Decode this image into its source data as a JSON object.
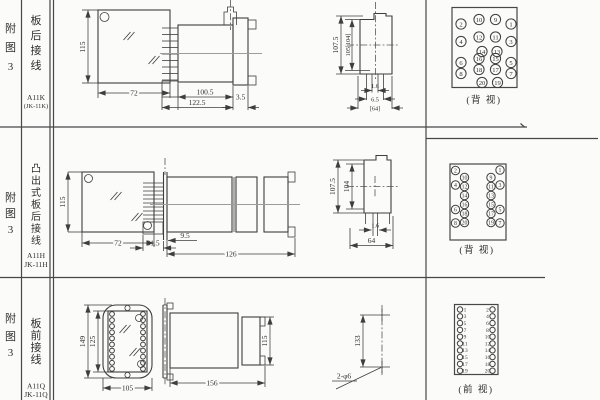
{
  "sheet": {
    "background": "#fbfbf9",
    "line_color": "#3e3e3e"
  },
  "rows": [
    {
      "fig": [
        "附",
        "图",
        "3"
      ],
      "wiring": [
        "板",
        "后",
        "接",
        "线"
      ],
      "model1": "A11K",
      "model2": "(JK-11K)",
      "view_label": "(背 视)",
      "front": {
        "h": "115",
        "w": "72"
      },
      "side": {
        "body": "100.5",
        "total": "122.5",
        "flange": "3.5"
      },
      "rear": {
        "h_outer": "107.5",
        "h_inner": "105[104]",
        "d1": "1.6",
        "d2": "6.5",
        "d3": "[64]"
      }
    },
    {
      "fig": [
        "附",
        "图",
        "3"
      ],
      "wiring": [
        "凸",
        "出",
        "式",
        "板",
        "后",
        "接",
        "线"
      ],
      "model1": "A11H",
      "model2": "JK-11H",
      "view_label": "(背 视)",
      "front": {
        "h": "115",
        "w": "72"
      },
      "side": {
        "offset": "9.5",
        "pins": "31.5",
        "total": "126"
      },
      "rear": {
        "h_outer": "107.5",
        "h_inner": "104",
        "d1": "1.6",
        "d2": "64"
      }
    },
    {
      "fig": [
        "附",
        "图",
        "3"
      ],
      "wiring": [
        "板",
        "前",
        "接",
        "线"
      ],
      "model1": "A11Q",
      "model2": "JK-11Q",
      "view_label": "(前 视)",
      "front": {
        "h_outer": "149",
        "h_inner": "125",
        "w": "105"
      },
      "side": {
        "total": "156",
        "sock_h": "115"
      },
      "holes": {
        "span": "133",
        "label": "2-φ6"
      }
    }
  ],
  "pin_diagrams": [
    {
      "name": "rear-view-grid-20pin",
      "r": 5.1,
      "font": 6.6,
      "pins": [
        {
          "n": "2",
          "x": 461,
          "y": 24
        },
        {
          "n": "10",
          "x": 479,
          "y": 19.5
        },
        {
          "n": "9",
          "x": 495.5,
          "y": 19.5
        },
        {
          "n": "1",
          "x": 511,
          "y": 24
        },
        {
          "n": "4",
          "x": 461,
          "y": 41.5
        },
        {
          "n": "12",
          "x": 479,
          "y": 37
        },
        {
          "n": "11",
          "x": 495.5,
          "y": 37
        },
        {
          "n": "3",
          "x": 511,
          "y": 41.5
        },
        {
          "n": "14",
          "x": 482,
          "y": 51.5
        },
        {
          "n": "13",
          "x": 497,
          "y": 51.5
        },
        {
          "n": "6",
          "x": 461,
          "y": 62.5
        },
        {
          "n": "16",
          "x": 479,
          "y": 58.5
        },
        {
          "n": "15",
          "x": 495.5,
          "y": 58.5
        },
        {
          "n": "5",
          "x": 511,
          "y": 62.5
        },
        {
          "n": "8",
          "x": 461,
          "y": 73.5
        },
        {
          "n": "18",
          "x": 479,
          "y": 69.5
        },
        {
          "n": "17",
          "x": 495.5,
          "y": 69.5
        },
        {
          "n": "7",
          "x": 511,
          "y": 73.5
        },
        {
          "n": "20",
          "x": 482,
          "y": 82.5
        },
        {
          "n": "19",
          "x": 497.5,
          "y": 82.5
        }
      ]
    },
    {
      "name": "rear-view-staggered-20pin",
      "r": 4.2,
      "font": 5.8,
      "pins": [
        {
          "n": "2",
          "x": 455.5,
          "y": 170.5
        },
        {
          "n": "10",
          "x": 464.5,
          "y": 177.5
        },
        {
          "n": "4",
          "x": 455.5,
          "y": 185
        },
        {
          "n": "12",
          "x": 464.5,
          "y": 186.5
        },
        {
          "n": "14",
          "x": 464.5,
          "y": 195.5
        },
        {
          "n": "16",
          "x": 464.5,
          "y": 204.5
        },
        {
          "n": "6",
          "x": 455.5,
          "y": 209.5
        },
        {
          "n": "18",
          "x": 464.5,
          "y": 213.5
        },
        {
          "n": "8",
          "x": 455.5,
          "y": 223
        },
        {
          "n": "20",
          "x": 464.5,
          "y": 222.5
        },
        {
          "n": "1",
          "x": 500,
          "y": 170
        },
        {
          "n": "9",
          "x": 491,
          "y": 177.5
        },
        {
          "n": "3",
          "x": 500,
          "y": 185
        },
        {
          "n": "11",
          "x": 491,
          "y": 186.5
        },
        {
          "n": "13",
          "x": 491,
          "y": 195.5
        },
        {
          "n": "15",
          "x": 491,
          "y": 204.5
        },
        {
          "n": "5",
          "x": 500,
          "y": 209.5
        },
        {
          "n": "17",
          "x": 491,
          "y": 213.5
        },
        {
          "n": "7",
          "x": 500,
          "y": 223
        },
        {
          "n": "19",
          "x": 491,
          "y": 222.5
        }
      ]
    },
    {
      "name": "front-view-columns-20pin",
      "r": 2.7,
      "font": 5.4,
      "pins": [
        {
          "n": "1",
          "x": 460,
          "y": 309.5,
          "tx": 465,
          "ta": "start"
        },
        {
          "n": "3",
          "x": 460,
          "y": 316.3,
          "tx": 465,
          "ta": "start"
        },
        {
          "n": "5",
          "x": 460,
          "y": 323.1,
          "tx": 465,
          "ta": "start"
        },
        {
          "n": "7",
          "x": 460,
          "y": 329.9,
          "tx": 465,
          "ta": "start"
        },
        {
          "n": "9",
          "x": 460,
          "y": 336.7,
          "tx": 465,
          "ta": "start"
        },
        {
          "n": "11",
          "x": 460,
          "y": 343.5,
          "tx": 465,
          "ta": "start"
        },
        {
          "n": "13",
          "x": 460,
          "y": 350.3,
          "tx": 465,
          "ta": "start"
        },
        {
          "n": "15",
          "x": 460,
          "y": 357.1,
          "tx": 465,
          "ta": "start"
        },
        {
          "n": "17",
          "x": 460,
          "y": 363.9,
          "tx": 465,
          "ta": "start"
        },
        {
          "n": "19",
          "x": 460,
          "y": 370.7,
          "tx": 465,
          "ta": "start"
        },
        {
          "n": "2",
          "x": 492.5,
          "y": 309.5,
          "tx": 487.5,
          "ta": "end"
        },
        {
          "n": "4",
          "x": 492.5,
          "y": 316.3,
          "tx": 487.5,
          "ta": "end"
        },
        {
          "n": "6",
          "x": 492.5,
          "y": 323.1,
          "tx": 487.5,
          "ta": "end"
        },
        {
          "n": "8",
          "x": 492.5,
          "y": 329.9,
          "tx": 487.5,
          "ta": "end"
        },
        {
          "n": "10",
          "x": 492.5,
          "y": 336.7,
          "tx": 487.5,
          "ta": "end"
        },
        {
          "n": "12",
          "x": 492.5,
          "y": 343.5,
          "tx": 487.5,
          "ta": "end"
        },
        {
          "n": "14",
          "x": 492.5,
          "y": 350.3,
          "tx": 487.5,
          "ta": "end"
        },
        {
          "n": "16",
          "x": 492.5,
          "y": 357.1,
          "tx": 487.5,
          "ta": "end"
        },
        {
          "n": "18",
          "x": 492.5,
          "y": 363.9,
          "tx": 487.5,
          "ta": "end"
        },
        {
          "n": "20",
          "x": 492.5,
          "y": 370.7,
          "tx": 487.5,
          "ta": "end"
        }
      ]
    },
    {
      "name": "terminal-screws",
      "r": 2.4,
      "font": 0,
      "pins": [
        {
          "n": "",
          "x": 112,
          "y": 314
        },
        {
          "n": "",
          "x": 112,
          "y": 320.1
        },
        {
          "n": "",
          "x": 112,
          "y": 326.2
        },
        {
          "n": "",
          "x": 112,
          "y": 332.3
        },
        {
          "n": "",
          "x": 112,
          "y": 338.4
        },
        {
          "n": "",
          "x": 112,
          "y": 344.5
        },
        {
          "n": "",
          "x": 112,
          "y": 350.6
        },
        {
          "n": "",
          "x": 112,
          "y": 356.7
        },
        {
          "n": "",
          "x": 112,
          "y": 362.8
        },
        {
          "n": "",
          "x": 112,
          "y": 368.9
        },
        {
          "n": "",
          "x": 143,
          "y": 314
        },
        {
          "n": "",
          "x": 143,
          "y": 320.1
        },
        {
          "n": "",
          "x": 143,
          "y": 326.2
        },
        {
          "n": "",
          "x": 143,
          "y": 332.3
        },
        {
          "n": "",
          "x": 143,
          "y": 338.4
        },
        {
          "n": "",
          "x": 143,
          "y": 344.5
        },
        {
          "n": "",
          "x": 143,
          "y": 350.6
        },
        {
          "n": "",
          "x": 143,
          "y": 356.7
        },
        {
          "n": "",
          "x": 143,
          "y": 362.8
        },
        {
          "n": "",
          "x": 143,
          "y": 368.9
        }
      ]
    }
  ]
}
